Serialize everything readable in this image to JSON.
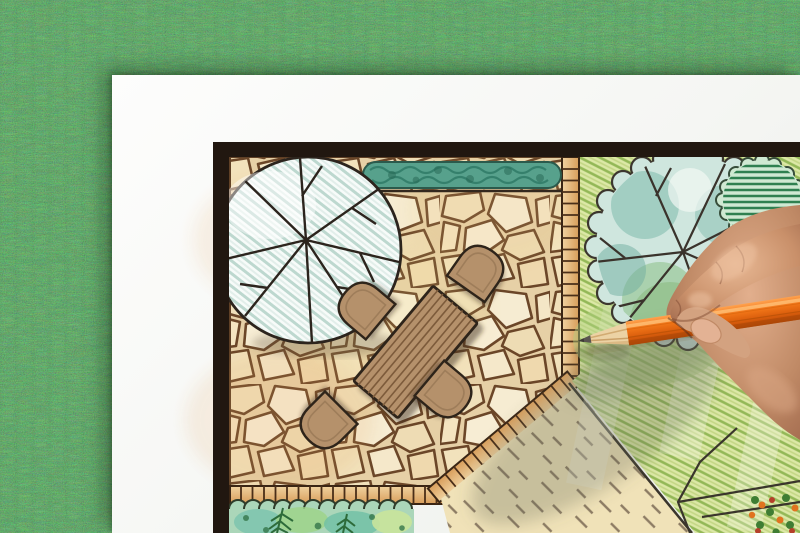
{
  "scene": {
    "type": "photograph",
    "description": "Close-up of a hand holding an orange colored pencil, drawing a landscape architecture garden plan on a white sheet of paper that lies on green grass",
    "objects": [
      "grass-background",
      "paper-sheet",
      "garden-plan-drawing",
      "plan-border-frame",
      "large-tree-symbol",
      "right-tree-symbol",
      "shrub-symbol",
      "hedge-strip",
      "flagstone-patio",
      "tile-edging-strips",
      "rectangular-garden-table",
      "four-garden-chairs",
      "lawn-area-hatched",
      "dashed-gravel-area",
      "planting-bed-with-conifer-sprigs",
      "corner-flower-bed",
      "human-hand",
      "orange-colored-pencil"
    ]
  },
  "palette": {
    "grass": "#3c7a3c",
    "paper": "#f5f6f3",
    "planBorder": "#211710",
    "stoneFill": "#f1e3c2",
    "stoneJoint": "#6b4628",
    "wood": "#b5916b",
    "woodStripe": "#7d5b3b",
    "outline": "#2e241a",
    "treeHatch": "#bdd8cf",
    "hedge": "#57a18c",
    "tileLight": "#f0d2a0",
    "tileDark": "#d89d5a",
    "lawnBase": "#dce8a6",
    "lawnHatch": "#93b857",
    "treeRight": "#cfe6de",
    "bedWash": "#abd6b9",
    "dashMark": "#8d7c64",
    "pencilOrange": "#f07417",
    "pencilWood": "#ecd2a4",
    "skin": "#c08a66",
    "skinHighlight": "#eec3a2",
    "skinShadow": "#9a6248",
    "flowerOrange": "#e0731f",
    "flowerGreen": "#3f7d33"
  }
}
